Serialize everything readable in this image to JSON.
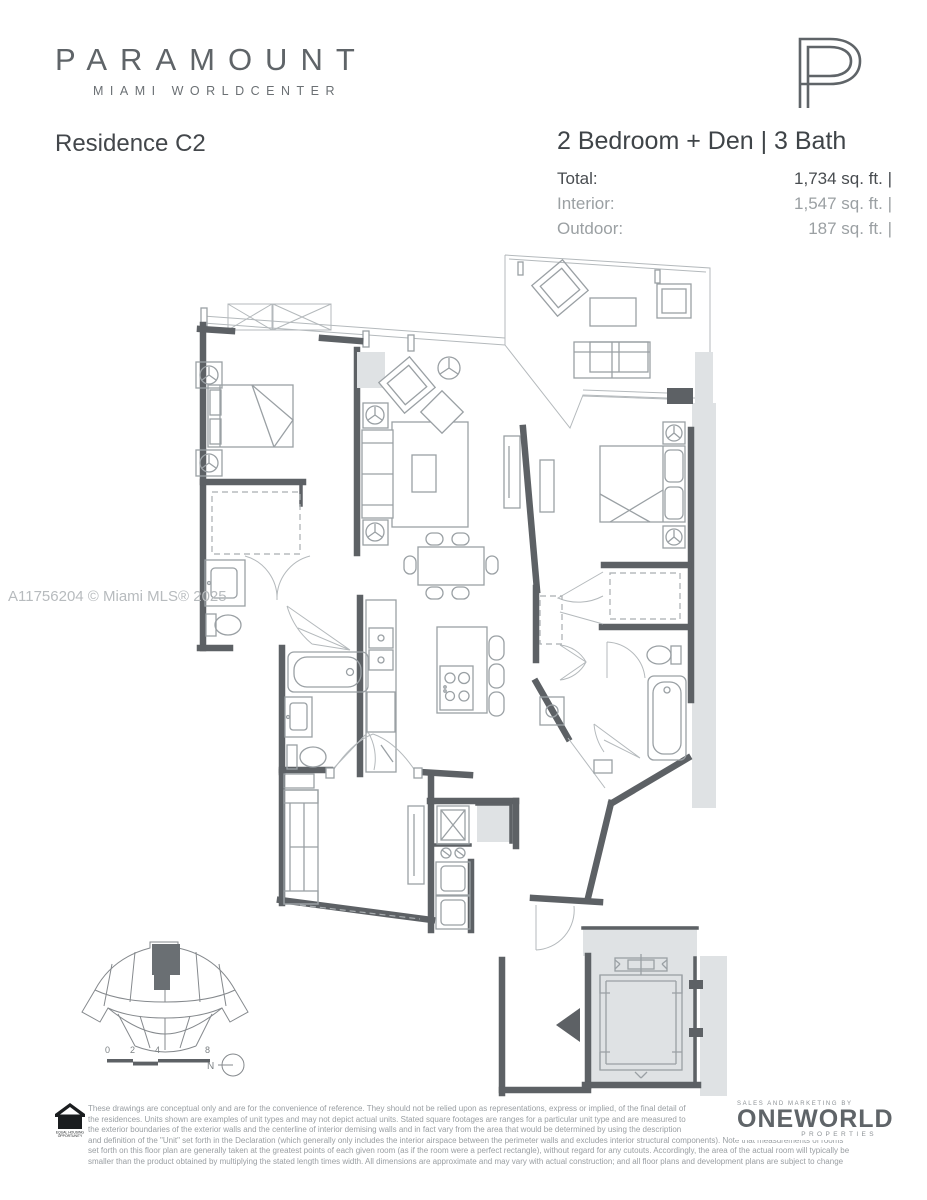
{
  "brand": {
    "logo_text": "PARAMOUNT",
    "logo_subtext": "MIAMI WORLDCENTER",
    "monogram": "P"
  },
  "header": {
    "residence": "Residence C2",
    "configuration": "2 Bedroom + Den | 3 Bath"
  },
  "areas": {
    "rows": [
      {
        "label": "Total:",
        "imperial": "1,734 sq. ft. |",
        "metric": "161 m",
        "sup": "2"
      },
      {
        "label": "Interior:",
        "imperial": "1,547 sq. ft. |",
        "metric": "144 m",
        "sup": "2"
      },
      {
        "label": "Outdoor:",
        "imperial": "187 sq. ft. |",
        "metric": "17 m",
        "sup": "2"
      }
    ]
  },
  "watermark": "A11756204 © Miami MLS® 2025",
  "keyplan": {
    "scale_labels": [
      "0",
      "2",
      "4",
      "8"
    ],
    "north_label": "N"
  },
  "footer": {
    "equal_housing_line1": "EQUAL HOUSING",
    "equal_housing_line2": "OPPORTUNITY",
    "disclaimer_lines": [
      "These drawings are conceptual only and are for the convenience of reference. They should not be relied upon as representations, express or implied, of the final detail of",
      "the residences. Units shown are examples of unit types and may not depict actual units. Stated square footages are ranges for a particular unit type and are measured to",
      "the exterior boundaries of the exterior walls and the centerline of interior demising walls and in fact vary from the area that would be determined by using the description",
      "and definition of the \"Unit\" set forth in the Declaration (which generally only includes the interior airspace between the perimeter walls and excludes interior structural components). Note that measurements of rooms",
      "set forth on this floor plan are generally taken at the greatest points of each given room (as if the room were a perfect rectangle), without regard for any cutouts.  Accordingly, the area of the actual room will typically be",
      "smaller than the product obtained by multiplying the stated length times width.  All dimensions are approximate and may vary with actual construction; and all floor plans and development plans are subject to change"
    ],
    "marketing": {
      "tagline": "SALES AND MARKETING BY",
      "name": "ONEWORLD",
      "subname": "PROPERTIES"
    }
  },
  "colors": {
    "wall": "#5d6165",
    "furn": "#9aa0a4",
    "thin": "#b4b9bc",
    "lightfill": "#dfe2e4"
  }
}
